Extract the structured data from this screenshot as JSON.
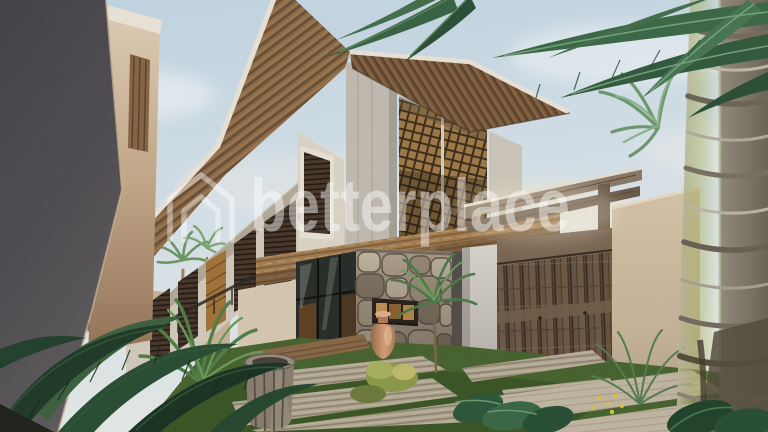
{
  "image": {
    "kind": "architectural-exterior-render",
    "subject": "Modern tropical two-storey villa with slatted wood roof, stone feature wall, weathered wooden entry gate, garden path and coconut palms",
    "width_px": 768,
    "height_px": 432
  },
  "watermark": {
    "text": "betterplace",
    "icon": "house-outline-icon",
    "color": "#ffffff",
    "opacity": "0.45"
  },
  "palette": {
    "sky_top": "#c3d7e5",
    "sky_horizon": "#e7edee",
    "roof_wood": "#8f6d4a",
    "wall_white": "#e3ddd0",
    "lattice_gold": "#a07c48",
    "stone": "#b2a48e",
    "gate_wood": "#5f4d3e",
    "beige_wall": "#cdbaa2",
    "palm_trunk": "#a59d8f",
    "foliage_dark": "#22402a",
    "foliage_mid": "#4f7d57",
    "grass": "#4a6631",
    "paver": "#b5ab97",
    "dark_wall": "#5b595e",
    "terracotta": "#c99573"
  },
  "scene": {
    "elements": [
      "sky",
      "clouds",
      "villa",
      "slatted-roof",
      "wood-lattice-screens",
      "stone-feature-wall",
      "glass-doors",
      "cantilever-wood-band",
      "entry-pergola",
      "wooden-gate",
      "boundary-wall",
      "coconut-palm",
      "garden-path",
      "tropical-plants",
      "clay-amphora",
      "barrel-planter",
      "watermark"
    ]
  }
}
